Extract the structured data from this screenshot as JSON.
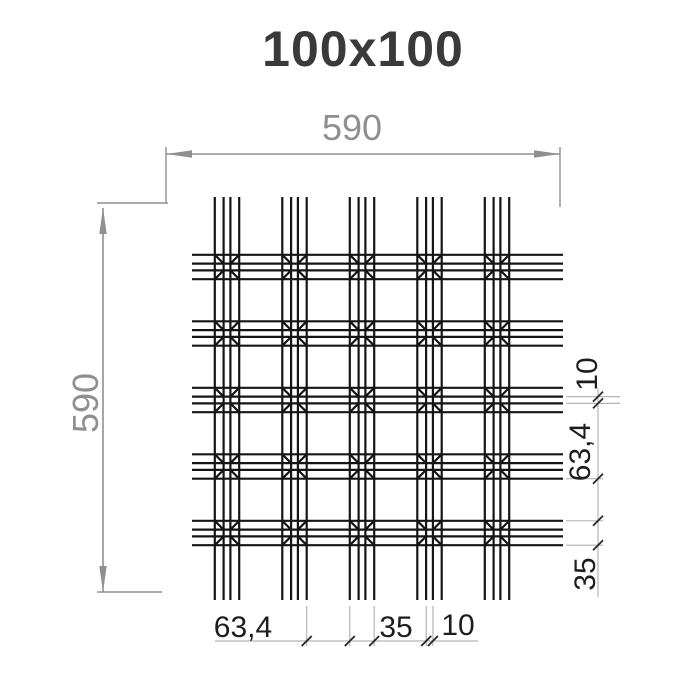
{
  "title": "100x100",
  "dimensions": {
    "top_width": "590",
    "left_height": "590",
    "bottom": [
      "63,4",
      "35",
      "10"
    ],
    "right": [
      "10",
      "63,4",
      "35"
    ]
  },
  "drawing": {
    "type": "grid-ceiling-panel-plan",
    "grid_rows": 5,
    "grid_columns": 5,
    "cell_style": "double-square-with-chamfered-corners"
  },
  "colors": {
    "background": "#ffffff",
    "grid_line": "#151515",
    "dim_primary": "#8f8f8f",
    "dim_extension": "#b4b4b4",
    "dim_tick": "#262626",
    "dim_text_small": "#1d1d1d",
    "title_text": "#3a3a3a"
  }
}
